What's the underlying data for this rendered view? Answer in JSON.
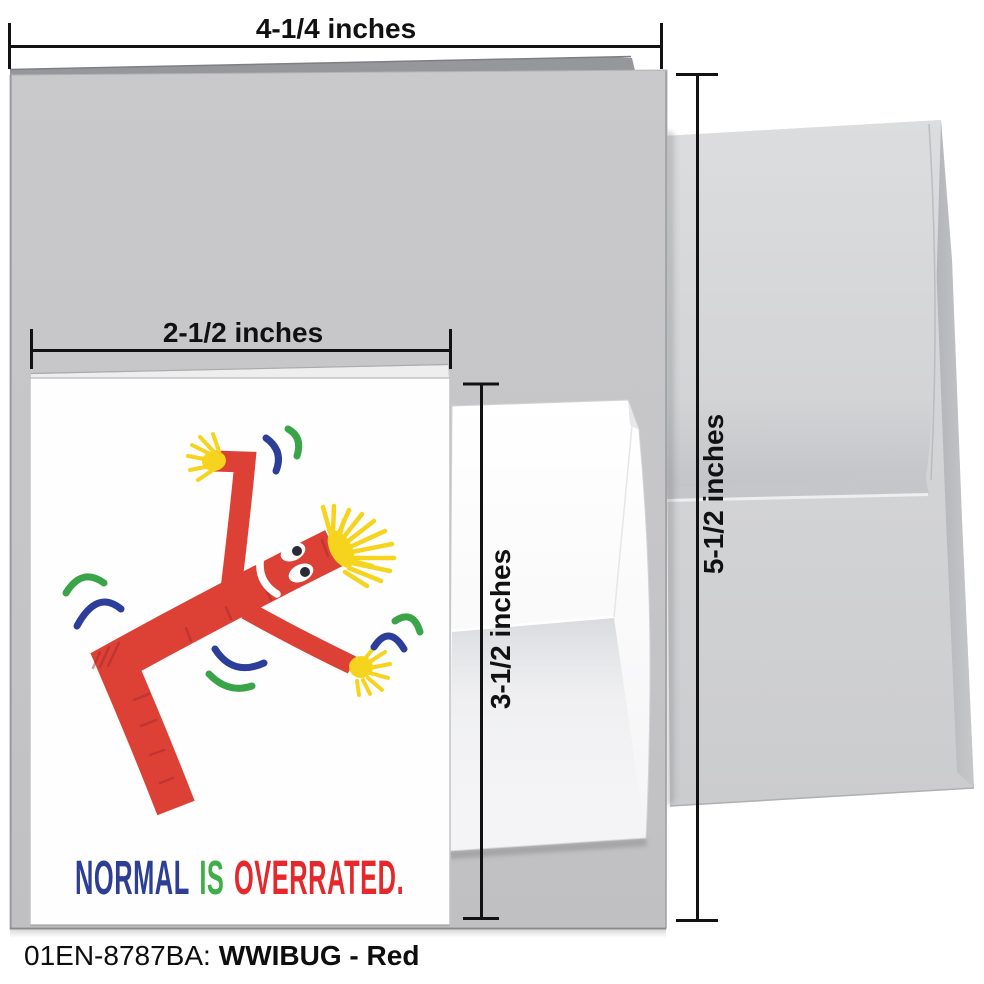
{
  "product": {
    "sku_label": "01EN-8787BA:",
    "variant_label": "WWIBUG - Red"
  },
  "dimension_labels": {
    "outer_card_width": "4-1/4 inches",
    "outer_card_height": "5-1/2 inches",
    "inner_card_width": "2-1/2 inches",
    "inner_card_height": "3-1/2 inches"
  },
  "inner_card": {
    "slogan": [
      {
        "text": "NORMAL",
        "color": "#2c3f94"
      },
      {
        "text": "IS",
        "color": "#3fae49"
      },
      {
        "text": "OVERRATED.",
        "color": "#e5282b"
      }
    ]
  },
  "illustration": {
    "name": "wacky-waving-inflatable-tube-man",
    "colors": {
      "body_red": "#dd4136",
      "hair_yellow": "#f6d41d",
      "arc_blue": "#2c3e9a",
      "arc_green": "#3aa449"
    }
  },
  "colors": {
    "outer_card_gray": "#c6c6c8",
    "outer_card_back_gray": "#96979a",
    "envelope_gray": "#d4d5d7",
    "small_envelope_white": "#fbfbfc",
    "dimension_line": "#121212",
    "background": "#ffffff"
  }
}
